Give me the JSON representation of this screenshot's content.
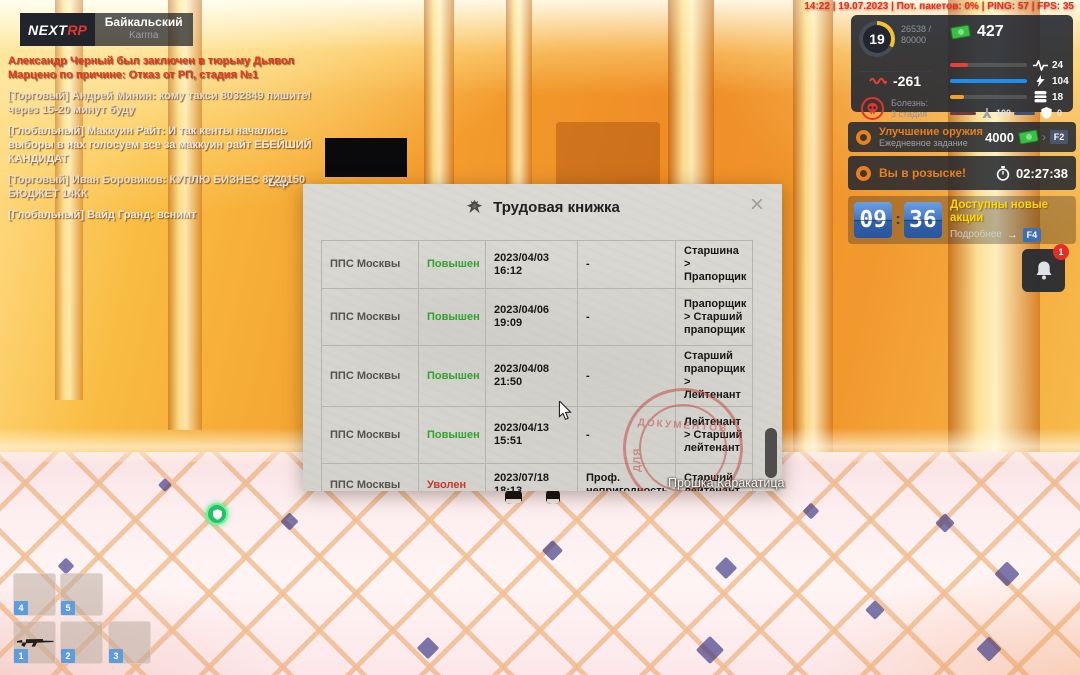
{
  "status_bar": {
    "text": "14:22 | 19.07.2023 | Пот. пакетов: 0% | PING: 57 | FPS: 35"
  },
  "logo": {
    "brand_left": "NEXT",
    "brand_right": "RP",
    "server_name": "Байкальский",
    "server_mode": "Karma"
  },
  "chat": {
    "lines": [
      {
        "text": "Александр Черный был заключен в тюрьму Дьявол Марцено по причине: Отказ от РП, стадия №1",
        "color": "#e23a1f"
      },
      {
        "text": "[Торговый] Андрей Минин: кому такси 8032849 пишите!через 15-20 минут буду",
        "color": "#e6dfd3"
      },
      {
        "text": "[Глобальный] Маккуин Райт: И так кенты начались выборы в нах голосуем все за маккуин райт ЕБЕЙШИЙ КАНДИДАТ",
        "color": "#efe9df"
      },
      {
        "text": "[Торговый] Иван Боровиков: КУПЛЮ БИЗНЕС 8720150 БЮДЖЕТ 14КК",
        "color": "#e6dfd3"
      },
      {
        "text": "[Глобальный] Вайд Гранд: вснимт",
        "color": "#efe9df"
      }
    ]
  },
  "world": {
    "bar_sign": "Бар",
    "player_name": "Прошка Каракатица"
  },
  "hud": {
    "level": "19",
    "xp_line1": "26538 /",
    "xp_line2": "80000",
    "money": "427",
    "karma": "-261",
    "disease_label": "Болезнь:",
    "disease_stage": "3 стадия",
    "bars": [
      {
        "name": "health",
        "value": "24",
        "pct": 24,
        "color": "#e8403a"
      },
      {
        "name": "energy",
        "value": "104",
        "pct": 100,
        "color": "#1e8df2"
      },
      {
        "name": "food",
        "value": "18",
        "pct": 18,
        "color": "#f0a32d"
      }
    ],
    "oxygen": "100",
    "armor": "0"
  },
  "quests": {
    "daily": {
      "title": "Улучшение оружия",
      "subtitle": "Ежедневное задание",
      "reward": "4000",
      "chevron": "›",
      "hotkey": "F2"
    },
    "wanted": {
      "title": "Вы в розыске!",
      "timer": "02:27:38"
    }
  },
  "promo": {
    "clock_hours": "09",
    "clock_colon": ":",
    "clock_minutes": "36",
    "title": "Доступны новые акции",
    "more_label": "Подробнее",
    "arrow": "→",
    "hotkey": "F4"
  },
  "notifications": {
    "badge_count": "1"
  },
  "modal": {
    "title": "Трудовая книжка",
    "close_glyph": "×",
    "stamp_word1": "ДЛЯ",
    "stamp_word2": "ДОКУМЕНТОВ",
    "rows": [
      {
        "org": "ППС Москвы",
        "status": "Повышен",
        "status_color": "#2fa32c",
        "date": "2023/04/03 16:12",
        "reason": "-",
        "rank": "Старшина > Прапорщик"
      },
      {
        "org": "ППС Москвы",
        "status": "Повышен",
        "status_color": "#2fa32c",
        "date": "2023/04/06 19:09",
        "reason": "-",
        "rank": "Прапорщик > Старший прапорщик"
      },
      {
        "org": "ППС Москвы",
        "status": "Повышен",
        "status_color": "#2fa32c",
        "date": "2023/04/08 21:50",
        "reason": "-",
        "rank": "Старший прапорщик > Лейтенант"
      },
      {
        "org": "ППС Москвы",
        "status": "Повышен",
        "status_color": "#2fa32c",
        "date": "2023/04/13 15:51",
        "reason": "-",
        "rank": "Лейтенант > Старший лейтенант"
      },
      {
        "org": "ППС Москвы",
        "status": "Уволен",
        "status_color": "#c5392b",
        "date": "2023/07/18 18:13",
        "reason": "Проф. непригодность",
        "rank": "Старший лейтенант"
      }
    ]
  },
  "inventory": {
    "slots": [
      {
        "num": "4"
      },
      {
        "num": "5"
      },
      {
        "num": "1",
        "item": "rifle"
      },
      {
        "num": "2"
      },
      {
        "num": "3"
      }
    ]
  },
  "colors": {
    "promoted": "#2fa32c",
    "fired": "#c5392b",
    "quest_accent": "#e8801e",
    "promo_title": "#ffd800",
    "hud_bg": "#252933"
  }
}
